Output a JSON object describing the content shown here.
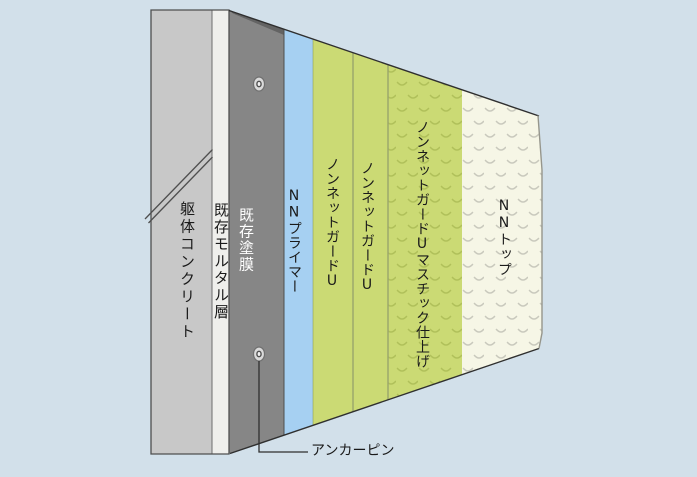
{
  "diagram": {
    "background_color": "#d2e0ea",
    "outline_color": "#2f2f2f",
    "layers": [
      {
        "id": "concrete",
        "label": "躯体コンクリート",
        "color": "#c8c8c8",
        "label_color": "#1a1a1a",
        "textured": false
      },
      {
        "id": "existing-mortar",
        "label": "既存モルタル層",
        "color": "#efefec",
        "label_color": "#1a1a1a",
        "textured": false
      },
      {
        "id": "existing-coating",
        "label": "既存塗膜",
        "color": "#868686",
        "label_color": "#ffffff",
        "textured": false
      },
      {
        "id": "nn-primer",
        "label": "NNプライマー",
        "color": "#a6d0f2",
        "label_color": "#1a1a1a",
        "textured": false
      },
      {
        "id": "nonnet-guard-u-1",
        "label": "ノンネットガードU",
        "color": "#cbda74",
        "label_color": "#1a1a1a",
        "textured": false
      },
      {
        "id": "nonnet-guard-u-2",
        "label": "ノンネットガードU",
        "color": "#cbda74",
        "label_color": "#1a1a1a",
        "textured": false
      },
      {
        "id": "nonnet-guard-u-mastic",
        "label": "ノンネットガードUマスチック仕上げ",
        "color": "#cbda74",
        "label_color": "#1a1a1a",
        "textured": true
      },
      {
        "id": "nn-top",
        "label": "NNトップ",
        "color": "#f6f6e6",
        "label_color": "#1a1a1a",
        "textured": true
      }
    ],
    "callout": {
      "id": "anchor-pin",
      "label": "アンカーピン",
      "pin_count": 2
    }
  }
}
